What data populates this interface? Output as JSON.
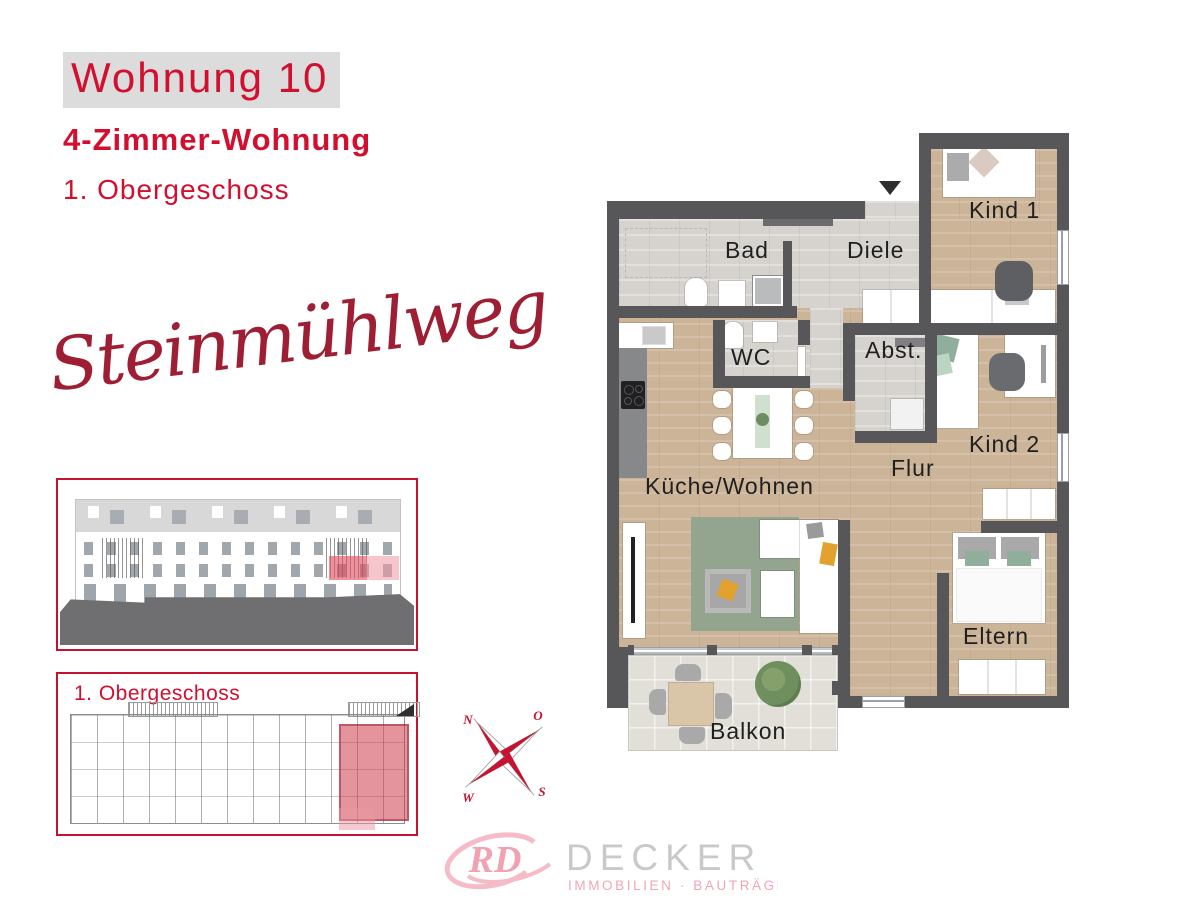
{
  "header": {
    "unit_title": "Wohnung 10",
    "unit_type": "4-Zimmer-Wohnung",
    "floor": "1. Obergeschoss"
  },
  "project_name": "Steinmühlweg",
  "overview_panel": {
    "floor_label": "1. Obergeschoss"
  },
  "compass": {
    "north": "N",
    "east": "O",
    "south": "S",
    "west": "W"
  },
  "floor_plan": {
    "rooms": {
      "bad": "Bad",
      "diele": "Diele",
      "kind1": "Kind 1",
      "wc": "WC",
      "abstellraum": "Abst.",
      "kind2": "Kind 2",
      "flur": "Flur",
      "kueche_wohnen": "Küche/Wohnen",
      "eltern": "Eltern",
      "balkon": "Balkon"
    }
  },
  "logo": {
    "monogram": "RD",
    "company": "DECKER",
    "tagline": "IMMOBILIEN · BAUTRÄGER"
  },
  "colors": {
    "brand_red": "#d30f2f",
    "script_red": "#9e1e33",
    "highlight_pink": "#e2556b",
    "wall_gray": "#57575a",
    "wood": "#ccb498",
    "tile": "#d6d3cf",
    "accent_green": "#93a58f",
    "accent_yellow": "#e2a32e",
    "logo_pink": "#f3b5c2",
    "logo_gray": "#c9c9c9"
  }
}
